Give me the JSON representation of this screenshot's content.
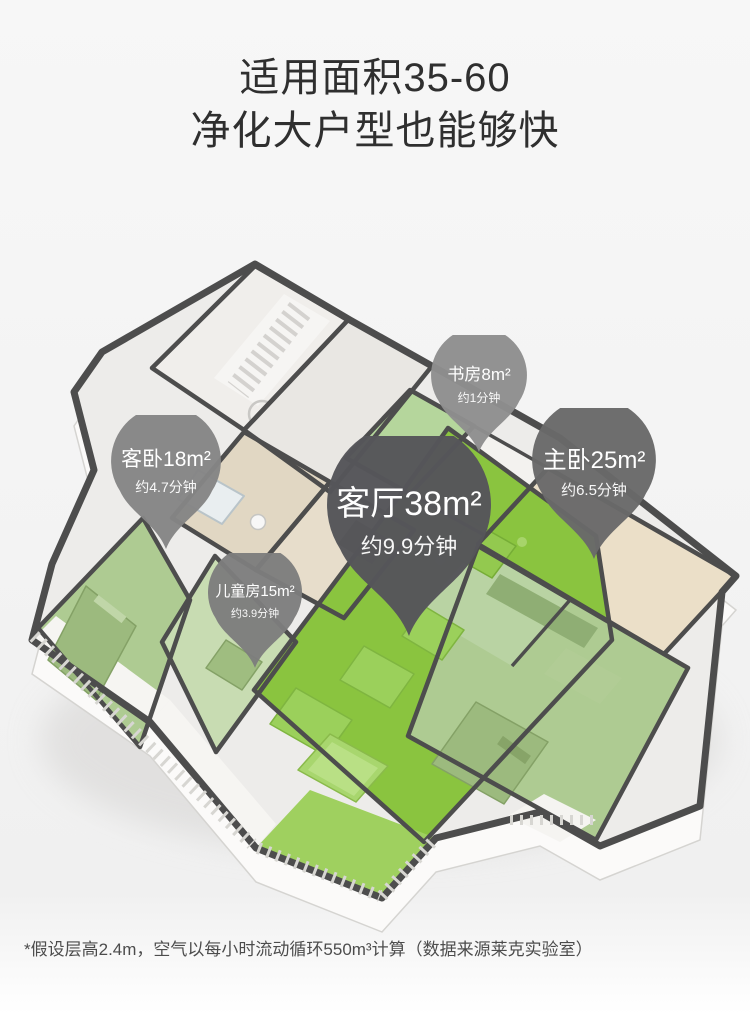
{
  "title": {
    "line1": "适用面积35-60",
    "line2": "净化大户型也能够快"
  },
  "pins": [
    {
      "room": "书房8m²",
      "time": "约1分钟",
      "color": "#8e8e8e"
    },
    {
      "room": "客卧18m²",
      "time": "约4.7分钟",
      "color": "#858585"
    },
    {
      "room": "主卧25m²",
      "time": "约6.5分钟",
      "color": "#696969"
    },
    {
      "room": "客厅38m²",
      "time": "约9.9分钟",
      "color": "#56565a"
    },
    {
      "room": "儿童房15m²",
      "time": "约3.9分钟",
      "color": "#7d7d7d"
    }
  ],
  "floorplan": {
    "highlight_green": "#8ac43f",
    "balcony_green": "#9fd05f",
    "sage_green": "#aecb92",
    "pale_green": "#c8dcb2",
    "study_green": "#b5d69c",
    "wall_color": "#4d4d4d"
  },
  "footnote": {
    "text": "*假设层高2.4m，空气以每小时流动循环550m³计算（数据来源莱克实验室）"
  }
}
